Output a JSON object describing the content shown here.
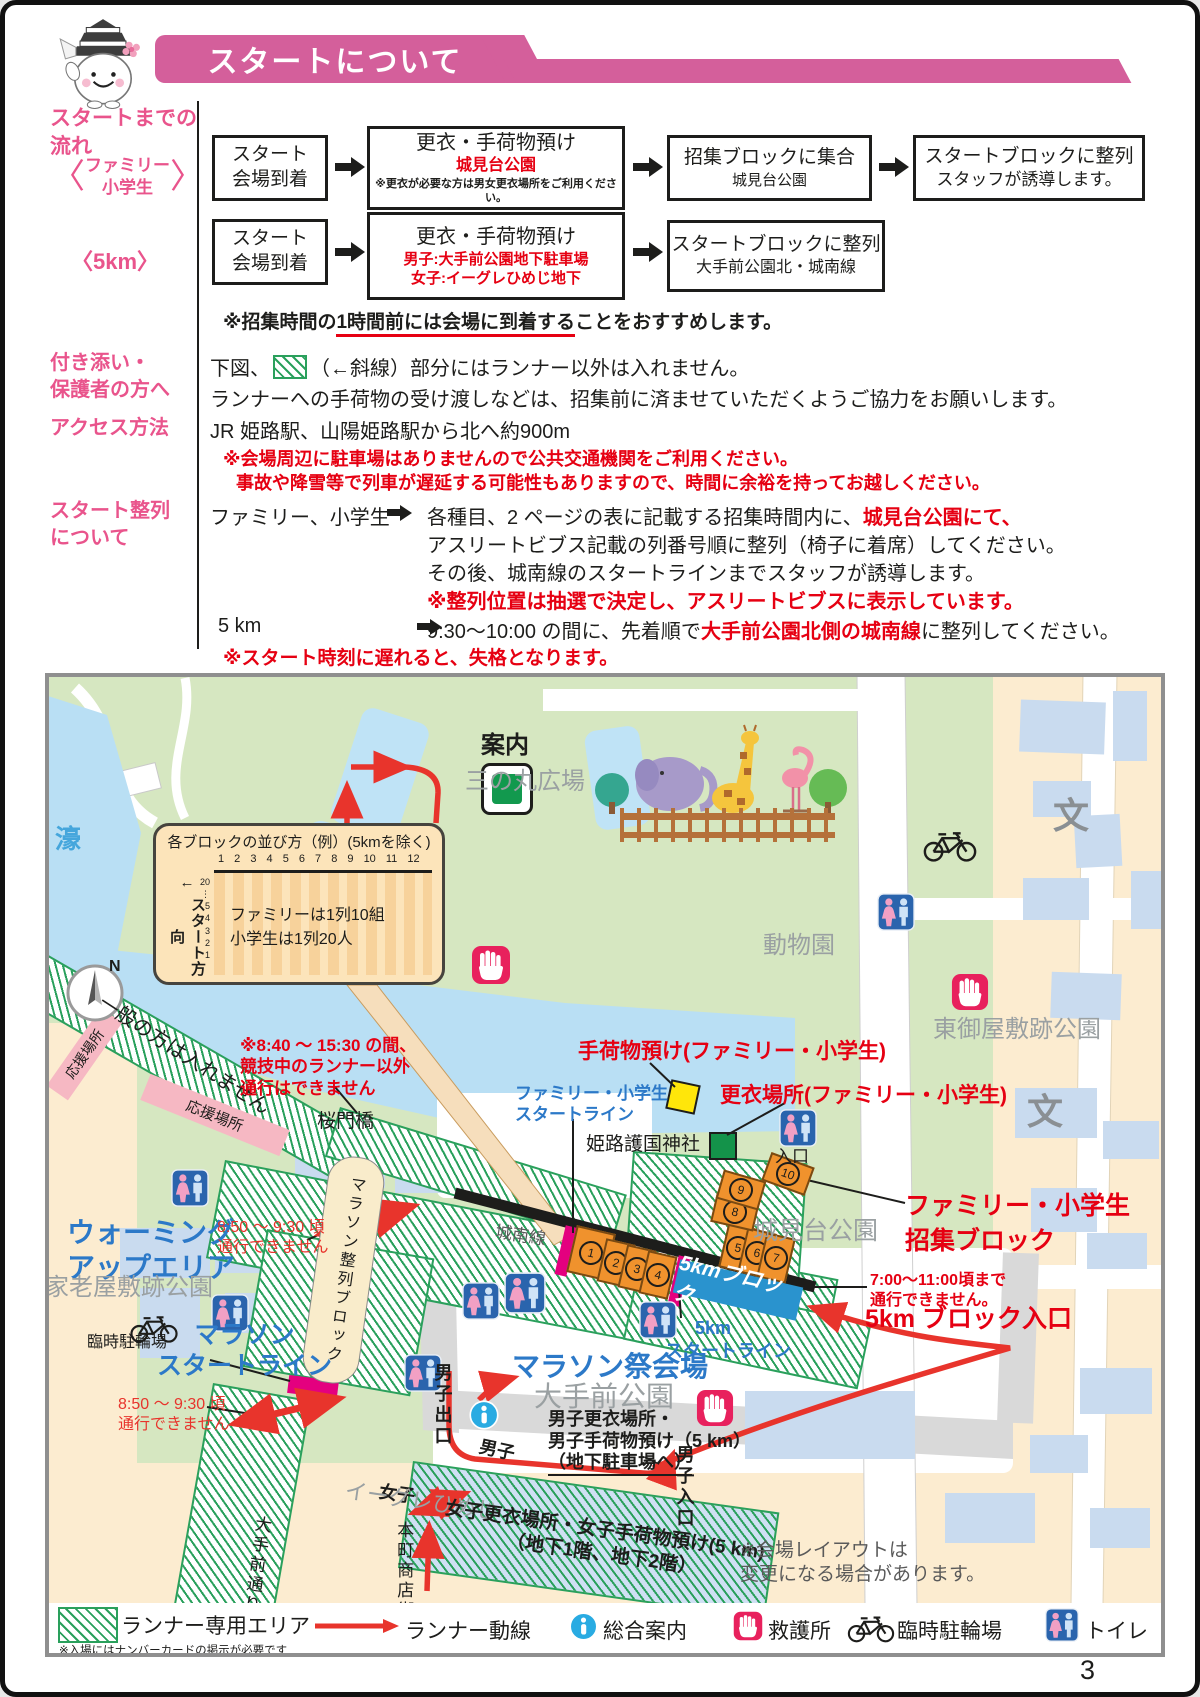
{
  "page_number": "3",
  "header": {
    "title": "スタートについて"
  },
  "colors": {
    "banner_pink": "#d45f9b",
    "side_label_pink": "#e9548c",
    "warning_red": "#e60012",
    "map_blue_label": "#2c79c8",
    "hatch_green": "#2aa05c",
    "block_orange": "#f0922d",
    "start_line_magenta": "#e4007f",
    "km5_block_blue": "#2a93ce",
    "water_blue": "#b9dff4",
    "park_green": "#d6e7c1",
    "urban_beige": "#fcecd0"
  },
  "flow": {
    "section_label": [
      "スタートまでの",
      "流れ"
    ],
    "family_tag": [
      "ファミリー",
      "小学生"
    ],
    "km5_tag": "〈5km〉",
    "arrive": [
      "スタート",
      "会場到着"
    ],
    "row1": {
      "b2_title": "更衣・手荷物預け",
      "b2_red": "城見台公園",
      "b2_note": "※更衣が必要な方は男女更衣場所をご利用ください。",
      "b3_title": "招集ブロックに集合",
      "b3_sub": "城見台公園",
      "b4_l1": "スタートブロックに整列",
      "b4_l2": "スタッフが誘導します。"
    },
    "row2": {
      "b2_title": "更衣・手荷物預け",
      "b2_red1": "男子:大手前公園地下駐車場",
      "b2_red2": "女子:イーグレひめじ地下",
      "b3_l1": "スタートブロックに整列",
      "b3_l2": "大手前公園北・城南線"
    },
    "note_prefix": "※招集時間の",
    "note_underline": "1時間前には会場に到着する",
    "note_suffix": "ことをおすすめします。"
  },
  "attend": {
    "label": [
      "付き添い・",
      "保護者の方へ"
    ],
    "l1a": "下図、",
    "l1b": "（←斜線）部分にはランナー以外は入れません。",
    "l2": "ランナーへの手荷物の受け渡しなどは、招集前に済ませていただくようご協力をお願いします。"
  },
  "access": {
    "label": "アクセス方法",
    "l1": "JR 姫路駅、山陽姫路駅から北へ約900m",
    "warn1": "※会場周辺に駐車場はありませんので公共交通機関をご利用ください。",
    "warn2": "事故や降雪等で列車が遅延する可能性もありますので、時間に余裕を持ってお越しください。"
  },
  "lineup": {
    "label": [
      "スタート整列",
      "について"
    ],
    "family": "ファミリー、小学生",
    "f1a": "各種目、2 ページの表に記載する招集時間内に、",
    "f1b": "城見台公園にて、",
    "f2": "アスリートビブス記載の列番号順に整列（椅子に着席）してください。",
    "f3": "その後、城南線のスタートラインまでスタッフが誘導します。",
    "f4": "※整列位置は抽選で決定し、アスリートビブスに表示しています。",
    "km5": "5 km",
    "k1a": "9:30〜10:00 の間に、先着順で",
    "k1b": "大手前公園北側の城南線",
    "k1c": "に整列してください。",
    "k2": "※スタート時刻に遅れると、失格となります。"
  },
  "map": {
    "inset": {
      "title": "各ブロックの並び方（例）(5kmを除く)",
      "columns": "1  2  3  4  5  6  7  8  9  10 11 12",
      "arrow": "←",
      "direction": "スタート方向",
      "rows": [
        "20",
        "⋮",
        "5",
        "4",
        "3",
        "2",
        "1"
      ],
      "t1": "ファミリーは1列10組",
      "t2": "小学生は1列20人"
    },
    "labels": {
      "moat": "濠",
      "sannomaru": "三の丸広場",
      "annai": "案内",
      "zoo": "動物園",
      "higashi": "東御屋敷跡公園",
      "school": "文",
      "general_no": "一般の方は入れません",
      "ouen": "応援場所",
      "notice840": [
        "※8:40 〜 15:30 の間、",
        "競技中のランナー以外",
        "通行はできません"
      ],
      "sakuramon": "桜門橋",
      "fam_start": [
        "ファミリー・小学生",
        "スタートライン"
      ],
      "gokoku": "姫路護国神社",
      "tenimotsu": "手荷物預け(ファミリー・小学生)",
      "koui": "更衣場所(ファミリー・小学生)",
      "iriguchi": "入口",
      "shiromidai": "城見台公園",
      "shushu": [
        "ファミリー・小学生",
        "招集ブロック"
      ],
      "no700": [
        "7:00〜11:00頃まで",
        "通行できません。"
      ],
      "blk5_entrance": "5km ブロック入口",
      "blk5": "5kmブロック",
      "start5": [
        "5km",
        "スタートライン"
      ],
      "jonansen": "城南線",
      "matsuri": "マラソン祭会場",
      "otemae": "大手前公園",
      "warming": [
        "ウォーミング",
        "アップエリア"
      ],
      "karou": "家老屋敷跡公園",
      "rinji": "臨時駐輪場",
      "mara_start": [
        "マラソン",
        "スタートライン"
      ],
      "seiretsu": "マラソン整列ブロック",
      "no850": [
        "8:50 〜 9:30 頃",
        "通行できません"
      ],
      "danshi_deguchi": "男子出口",
      "danshi": "男子",
      "joshi": "女子",
      "danshi_iri": "男子入口",
      "danshi_koui": [
        "男子更衣場所・",
        "男子手荷物預け（5 km）",
        "（地下駐車場へ）"
      ],
      "eagle": "イーグレひめじ",
      "joshi_koui": [
        "女子更衣場所・女子手荷物預け(5 km)",
        "（地下1階、地下2階）"
      ],
      "honmachi": "本町商店街",
      "otemae_dori": "大手前通り",
      "layout_note": [
        "※会場レイアウトは",
        "変更になる場合があります。"
      ],
      "north": "N"
    },
    "block_numbers": [
      "1",
      "2",
      "3",
      "4",
      "5",
      "6",
      "7",
      "8",
      "9",
      "10"
    ]
  },
  "legend": {
    "runner_area": "ランナー専用エリア",
    "runner_area_note": "※入場にはナンバーカードの掲示が必要です",
    "runner_flow": "ランナー動線",
    "info": "総合案内",
    "aid": "救護所",
    "bike": "臨時駐輪場",
    "toilet": "トイレ"
  }
}
